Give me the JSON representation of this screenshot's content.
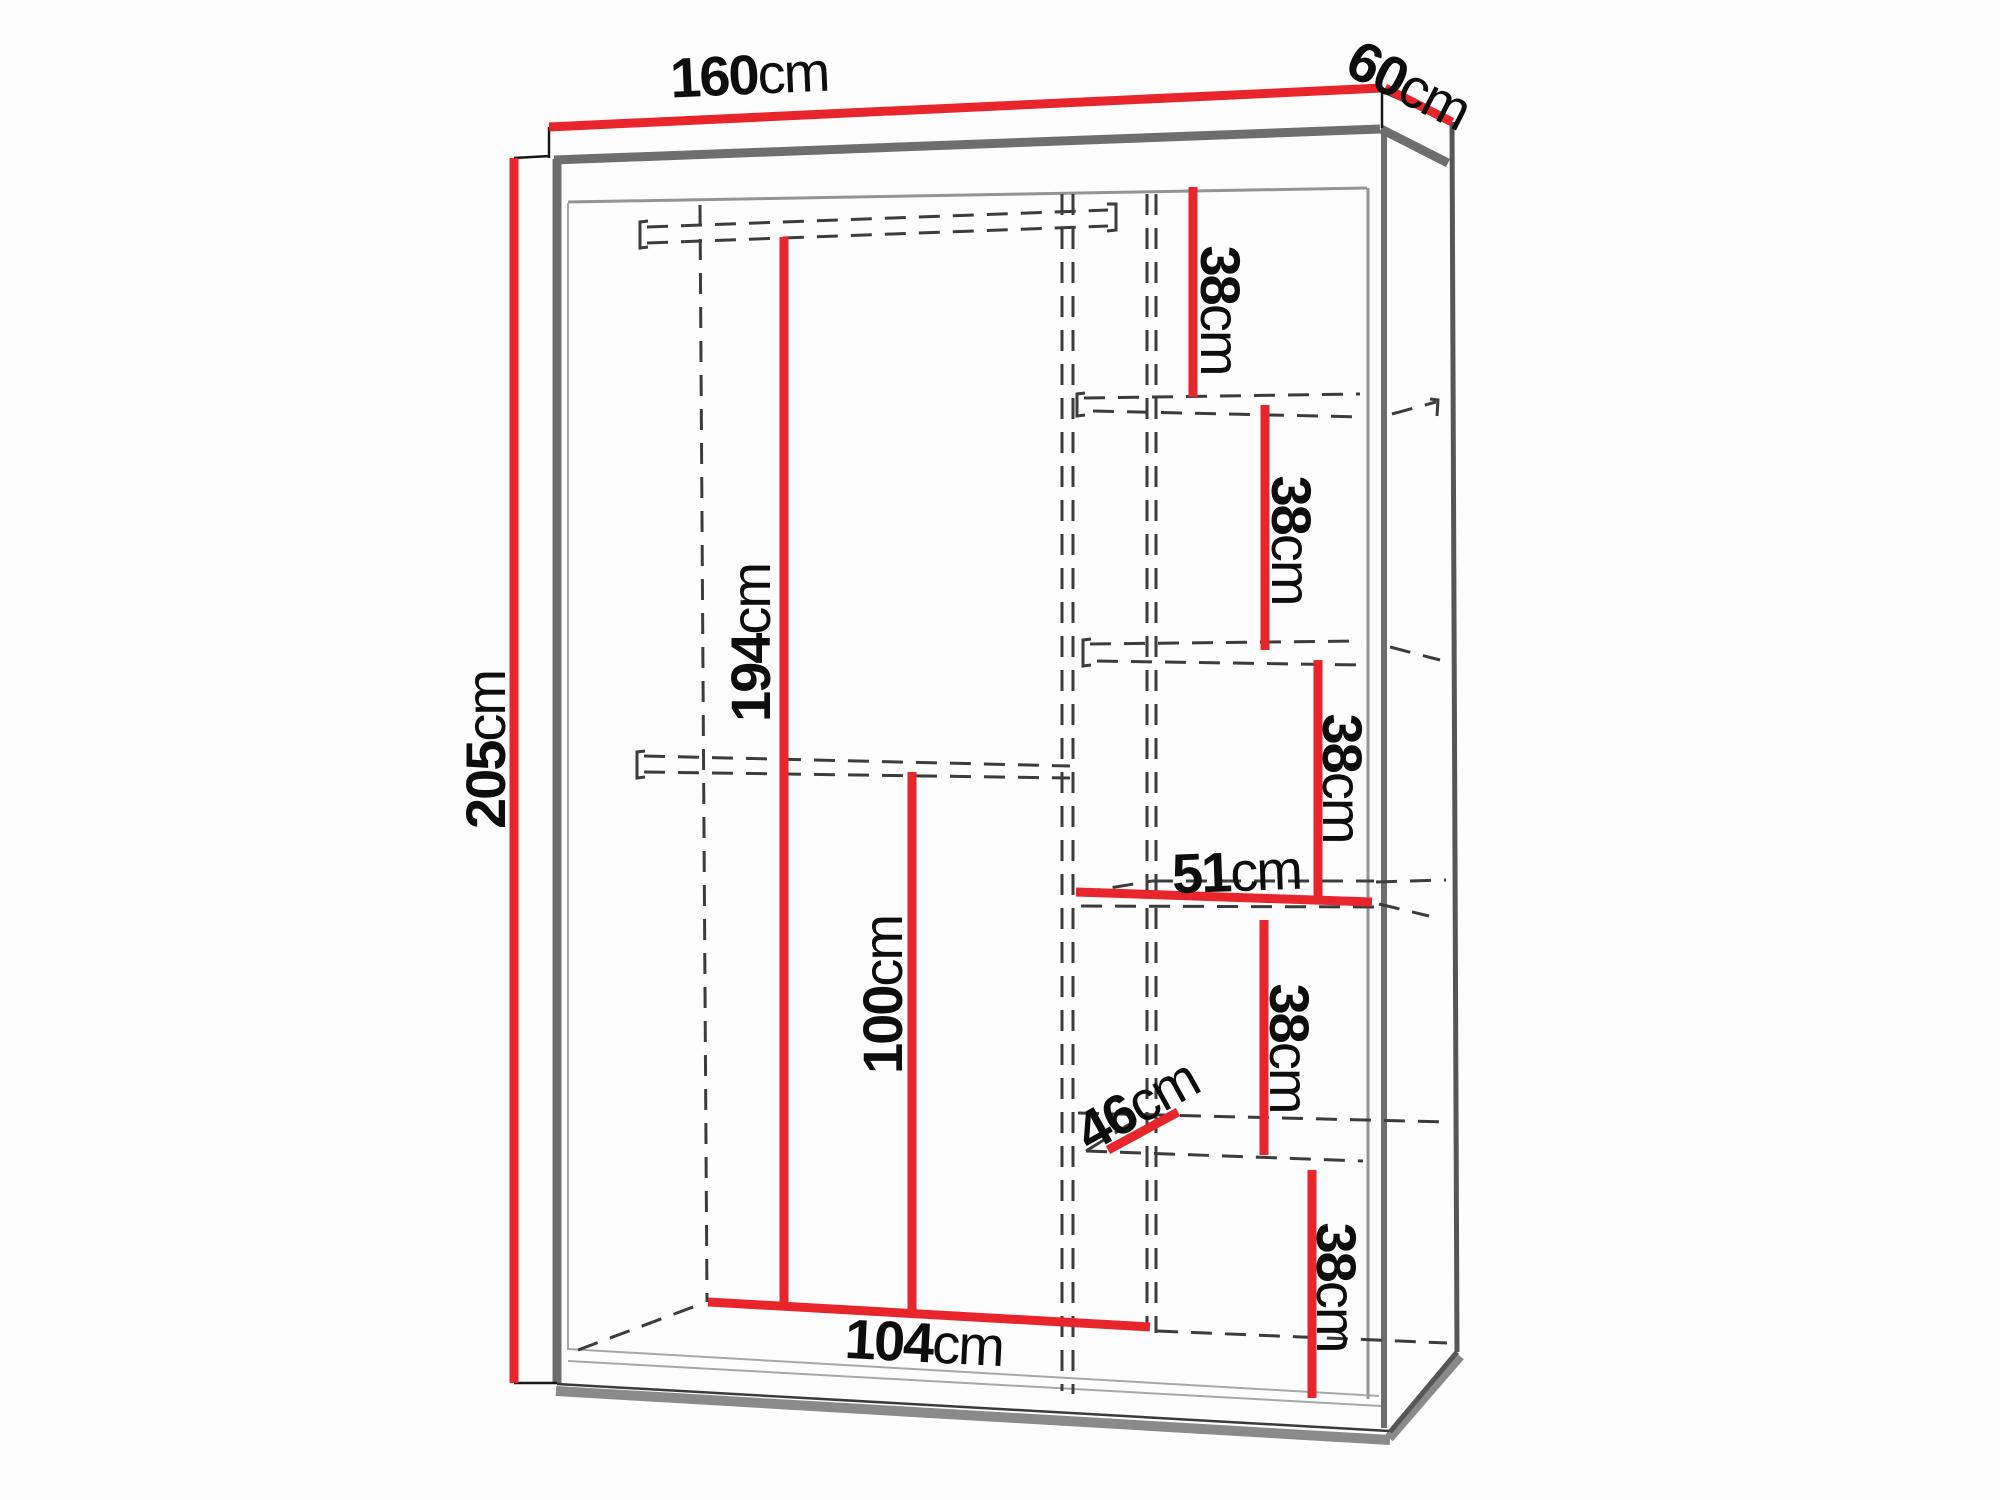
{
  "diagram": {
    "name": "wardrobe-dimension-diagram",
    "unit": "cm",
    "accent_color": "#e8252b",
    "outline_color": "#6e6e6e",
    "dash_color": "#3c3c3c",
    "labels": {
      "width": {
        "value": "160",
        "unit": "cm"
      },
      "depth": {
        "value": "60",
        "unit": "cm"
      },
      "height": {
        "value": "205",
        "unit": "cm"
      },
      "hanging_section_height": {
        "value": "194",
        "unit": "cm"
      },
      "rod_to_floor_height": {
        "value": "100",
        "unit": "cm"
      },
      "interior_width": {
        "value": "104",
        "unit": "cm"
      },
      "shelf_width": {
        "value": "51",
        "unit": "cm"
      },
      "shelf_depth": {
        "value": "46",
        "unit": "cm"
      },
      "shelf_gaps": [
        {
          "value": "38",
          "unit": "cm"
        },
        {
          "value": "38",
          "unit": "cm"
        },
        {
          "value": "38",
          "unit": "cm"
        },
        {
          "value": "38",
          "unit": "cm"
        },
        {
          "value": "38",
          "unit": "cm"
        }
      ]
    }
  }
}
